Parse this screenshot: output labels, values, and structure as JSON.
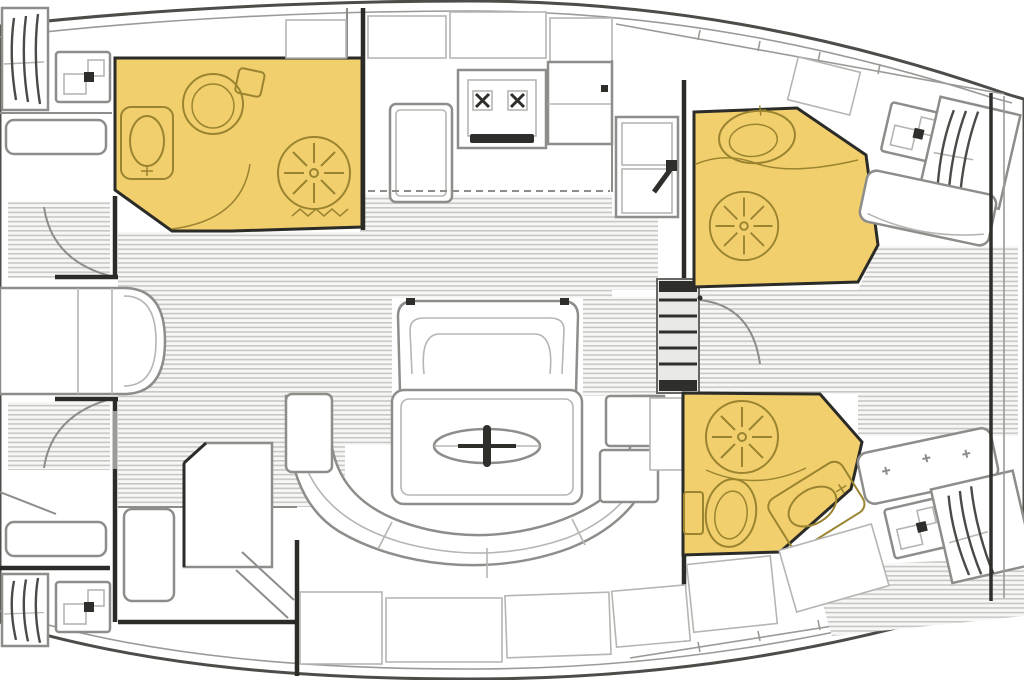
{
  "document": {
    "kind": "sailing-yacht-interior-floor-plan",
    "orientation": "bow-left-stern-right",
    "visible_text": []
  },
  "colors": {
    "hull": "#4c4c49",
    "deck_line": "#9a9a97",
    "wall": "#2b2b28",
    "furniture": "#8d8d8a",
    "furniture_light": "#b5b5b2",
    "head_fill": "#f2cf6d",
    "head_fixture": "#9a8430",
    "sole_stripe": "#c7c7c5",
    "sole_bg": "#f7f7f5",
    "dark_detail": "#2e2e2b"
  },
  "rooms": [
    {
      "name": "owner-cabin-forward",
      "fixtures": [
        "island-berth",
        "wardrobe-port",
        "wardrobe-starboard",
        "vanity-sink-port",
        "vanity-sink-starboard",
        "seat-port",
        "seat-starboard",
        "entry-door-port",
        "entry-door-starboard"
      ]
    },
    {
      "name": "head-forward",
      "highlighted": true,
      "fixtures": [
        "washbasin",
        "toilet",
        "shower",
        "towel-rail",
        "door"
      ]
    },
    {
      "name": "galley",
      "fixtures": [
        "two-burner-stove",
        "refrigerator-counter",
        "double-sink",
        "overhead-lockers",
        "counter"
      ]
    },
    {
      "name": "salon",
      "fixtures": [
        "folding-table",
        "forward-bench",
        "u-shaped-settee",
        "side-cabinets",
        "storage-lockers"
      ]
    },
    {
      "name": "companionway",
      "fixtures": [
        "steps",
        "door"
      ]
    },
    {
      "name": "head-aft-starboard",
      "highlighted": true,
      "fixtures": [
        "washbasin",
        "shower",
        "curtain"
      ]
    },
    {
      "name": "cabin-aft-starboard",
      "fixtures": [
        "berth",
        "hanging-locker",
        "vanity-sink",
        "seat",
        "shelf"
      ]
    },
    {
      "name": "head-aft-port",
      "highlighted": true,
      "fixtures": [
        "shower",
        "toilet",
        "washbasin"
      ]
    },
    {
      "name": "cabin-aft-port",
      "fixtures": [
        "berth",
        "hanging-locker",
        "vanity-sink",
        "tufted-seat",
        "locker"
      ]
    }
  ]
}
